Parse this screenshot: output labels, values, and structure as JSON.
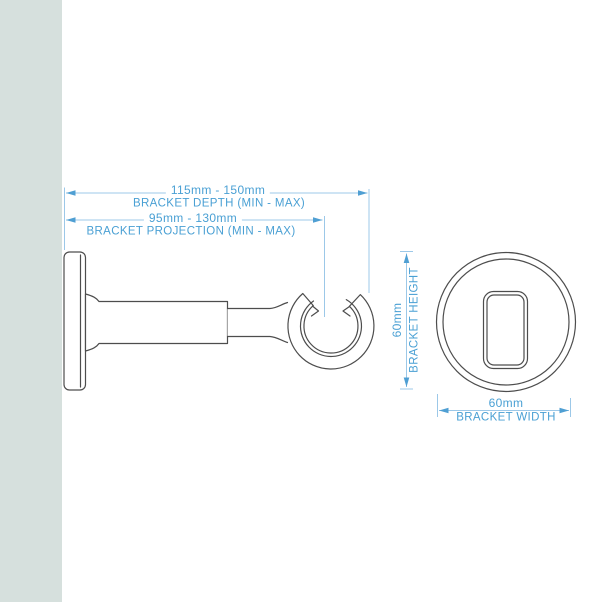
{
  "dims": {
    "depth": {
      "value": "115mm - 150mm",
      "label": "BRACKET DEPTH (MIN - MAX)"
    },
    "projection": {
      "value": "95mm - 130mm",
      "label": "BRACKET PROJECTION (MIN - MAX)"
    },
    "height": {
      "value": "60mm",
      "label": "BRACKET HEIGHT"
    },
    "width": {
      "value": "60mm",
      "label": "BRACKET WIDTH"
    }
  },
  "colors": {
    "dimension_text": "#4aa0d4",
    "dimension_line": "#9cc8e8",
    "dimension_arrow": "#4f9fd3",
    "drawing_outline": "#4d4d4d",
    "wall_strip": "#d6e0dd",
    "background": "#ffffff"
  }
}
